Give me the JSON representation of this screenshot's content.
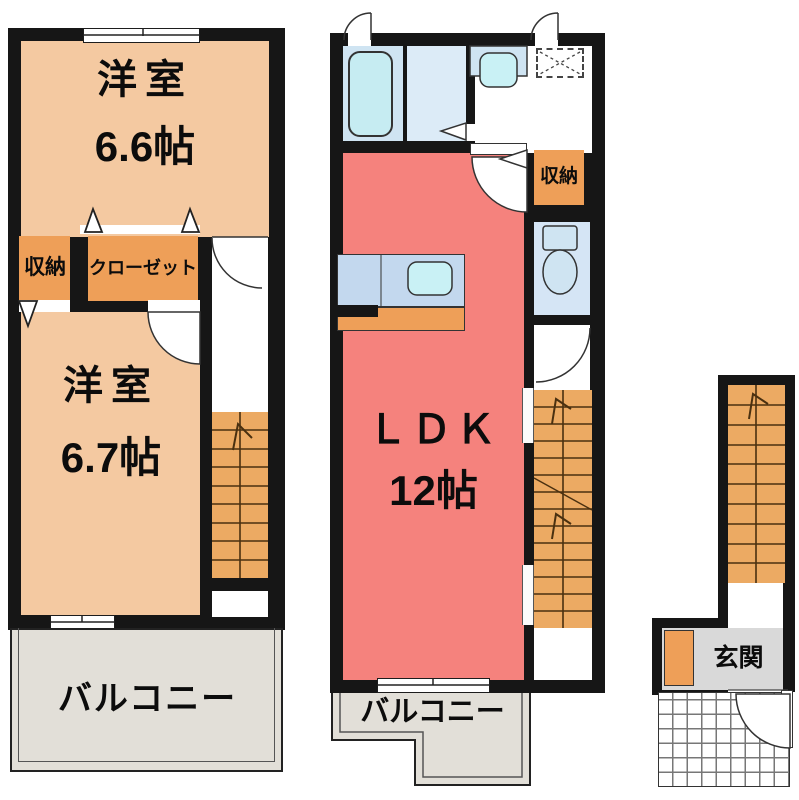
{
  "rooms": {
    "western_room_66": {
      "name": "洋室",
      "size": "6.6帖"
    },
    "western_room_67": {
      "name": "洋室",
      "size": "6.7帖"
    },
    "ldk": {
      "name": "ＬＤＫ",
      "size": "12帖"
    },
    "storage_left": {
      "label": "収納"
    },
    "closet": {
      "label": "クローゼット"
    },
    "storage_right": {
      "label": "収納"
    },
    "balcony_left": {
      "label": "バルコニー"
    },
    "balcony_main": {
      "label": "バルコニー"
    },
    "entrance": {
      "label": "玄関"
    }
  },
  "colors": {
    "wall": "#161616",
    "western_room": "#f4c9a1",
    "closet_orange": "#ee9f58",
    "stairs_orange": "#ecaa63",
    "ldk_red": "#f5827d",
    "balcony_gray": "#e2dfd8",
    "entrance_gray": "#d9d9d9",
    "bath_blue": "#cfe4f2",
    "washroom_blue": "#dcebf7",
    "kitchen_blue": "#c3d8ee",
    "sink_cyan": "#c9f1f5",
    "toilet_blue": "#d5e5f5",
    "fixture_cyan": "#c6ecf2"
  }
}
